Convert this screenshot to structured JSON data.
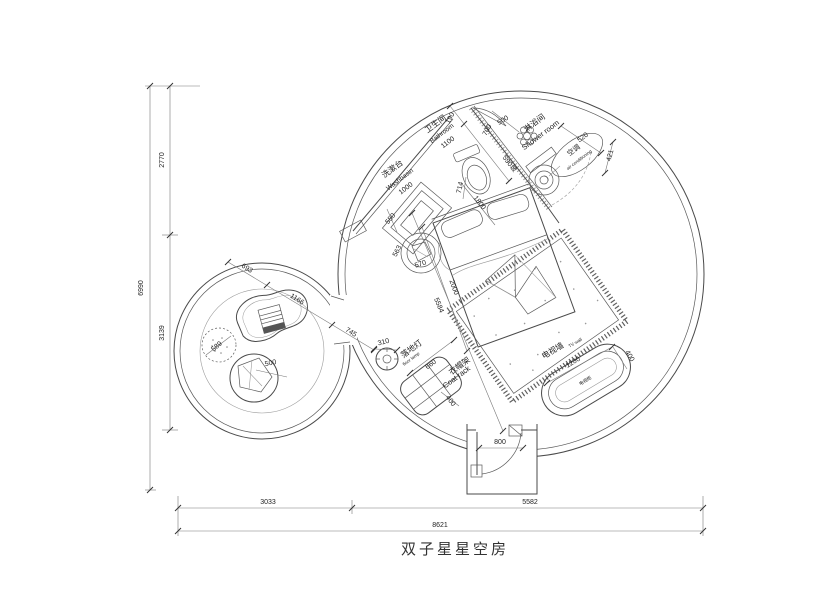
{
  "title": "双子星星空房",
  "colors": {
    "line": "#4a4a4a",
    "dim": "#555555",
    "text": "#222222",
    "dark_fill": "#6e6e6e",
    "bg": "#ffffff"
  },
  "overall": {
    "height_total": "6990",
    "height_top": "2770",
    "height_bottom": "3139",
    "width_left": "3033",
    "width_right": "5582",
    "width_total": "8621"
  },
  "bathroom": {
    "label_cn": "卫生间",
    "label_en": "Bathroom",
    "width": "1100",
    "d_190": "190",
    "d_700": "700",
    "d_500": "500",
    "d_1800": "1800",
    "d_714": "714",
    "d_glass": "590玻"
  },
  "washbasin": {
    "label_cn": "洗漱台",
    "label_en": "Washbasin",
    "width": "1000",
    "d_550": "550"
  },
  "shower": {
    "label_cn": "淋浴间",
    "label_en": "Shower room",
    "d_520": "520",
    "d_421": "421"
  },
  "aircon": {
    "label_cn": "空调",
    "label_en": "air conditioning"
  },
  "bed_area": {
    "d_2000": "2000",
    "d_5584": "5584",
    "stool_w": "563",
    "stool_h": "570"
  },
  "floor_lamp": {
    "label_cn": "落地灯",
    "label_en": "floor lamp",
    "d_310": "310"
  },
  "coat_rack": {
    "label_cn": "衣帽架",
    "label_en": "Coat rack",
    "d_660": "660",
    "d_400": "400"
  },
  "tv_wall": {
    "label_cn": "电视墙",
    "label_en": "TV wall",
    "cabinet": "电视柜",
    "d_1200": "1200",
    "d_400": "400"
  },
  "lounge": {
    "d_693": "693",
    "d_1166": "1166",
    "d_745": "745",
    "pouf": "589",
    "blanket": "500"
  },
  "entrance": {
    "door_width": "800"
  }
}
